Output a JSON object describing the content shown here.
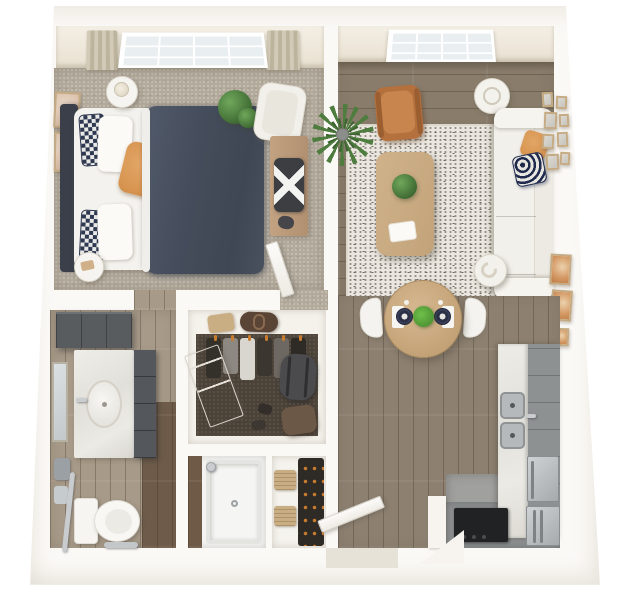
{
  "scene": {
    "type": "3d-floor-plan-render",
    "description": "Top-down 3D rendered floor plan of a one-bedroom apartment with bedroom, living room, dining area, kitchen, bathroom, walk-in closet, shower room, coat closet and entry",
    "background": "#ffffff",
    "text_visible": "none"
  },
  "palette": {
    "outer_wall": "#fbf9f6",
    "wall_face_cream": "#efe8da",
    "bedroom_carpet": "#b3aa9c",
    "wood_floor": "#897c6b",
    "hall_wood_floor": "#8d8071",
    "bath_wood_floor": "#a89a88",
    "bath_dark_wood": "#6e5b49",
    "rug": "#ebe7df",
    "closet_carpet": "#4b4238",
    "duvet_navy": "#48515f",
    "headboard": "#3a3f4a",
    "accent_orange": "#d79450",
    "leather_cognac": "#b4713e",
    "sofa_white": "#f2f0eb",
    "wood_furniture": "#c9aa82",
    "kitchen_cabinet_gray": "#8e9192",
    "counter_marble": "#e9e7e2",
    "stainless": "#b5b9bb",
    "cooktop_black": "#212224",
    "vanity_dark_gray": "#56595c",
    "hanger_orange": "#c97c2e",
    "plant_green": "#4e7d3f",
    "curtain_beige": "#c8c0aa"
  },
  "rooms": [
    {
      "name": "Bedroom",
      "floor": "beige carpet",
      "features": [
        "grid window with beige curtains",
        "queen bed with navy duvet and white sheets",
        "charcoal headboard",
        "2 checkered navy pillows",
        "orange accent pillow",
        "2 round white nightstands",
        "table lamp",
        "white armchair",
        "potted plant",
        "2 blush wall art frames",
        "wood desk with X-base chair",
        "interior door"
      ]
    },
    {
      "name": "Living Room",
      "floor": "wood plank",
      "features": [
        "grid window",
        "palm plant",
        "cognac leather armchair",
        "white drum floor lamp",
        "white sofa",
        "orange pillow",
        "navy wave-pattern pillow",
        "speckled area rug",
        "wood coffee table with plant and white tray",
        "gallery wall of 8 frames",
        "sculptural white floor lamp",
        "2 warm abstract prints",
        "wood desk with X-base chair"
      ]
    },
    {
      "name": "Dining Area",
      "floor": "wood plank",
      "features": [
        "round wood table",
        "2 white chairs",
        "2 dark place settings on white mats",
        "green centerpiece"
      ]
    },
    {
      "name": "Kitchen",
      "floor": "gray",
      "features": [
        "gray cabinet run",
        "marble countertop",
        "double stainless sink",
        "faucet",
        "stainless dishwasher",
        "black cooktop",
        "stainless refrigerator",
        "white half wall"
      ]
    },
    {
      "name": "Bathroom",
      "floor": "wood plank with dark accent",
      "features": [
        "dark gray upper cabinets",
        "marble vanity with oval sink",
        "faucet",
        "dark drawer stack",
        "wall mirror",
        "2 gray towels",
        "chrome grab bar",
        "toilet",
        "chrome floor fixture"
      ]
    },
    {
      "name": "Walk-in Closet",
      "floor": "dark brown carpet",
      "features": [
        "hanging clothes with orange hangers",
        "shelf with tan bag and brown duffel",
        "leaning white door",
        "gray duffel bag",
        "brown leather bag"
      ]
    },
    {
      "name": "Shower Room",
      "floor": "white tile",
      "features": [
        "walk-in shower tray with drain",
        "chrome shower head",
        "dark wood accent wall"
      ]
    },
    {
      "name": "Coat Closet",
      "floor": "white",
      "features": [
        "hanging dark coats with orange hangers",
        "2 tan woven baskets"
      ]
    },
    {
      "name": "Entry",
      "floor": "wood plank",
      "features": [
        "open white front door",
        "angled wall"
      ]
    }
  ],
  "counts": {
    "windows": 2,
    "doors": 3,
    "rooms": 9,
    "gallery_frames": 8
  }
}
